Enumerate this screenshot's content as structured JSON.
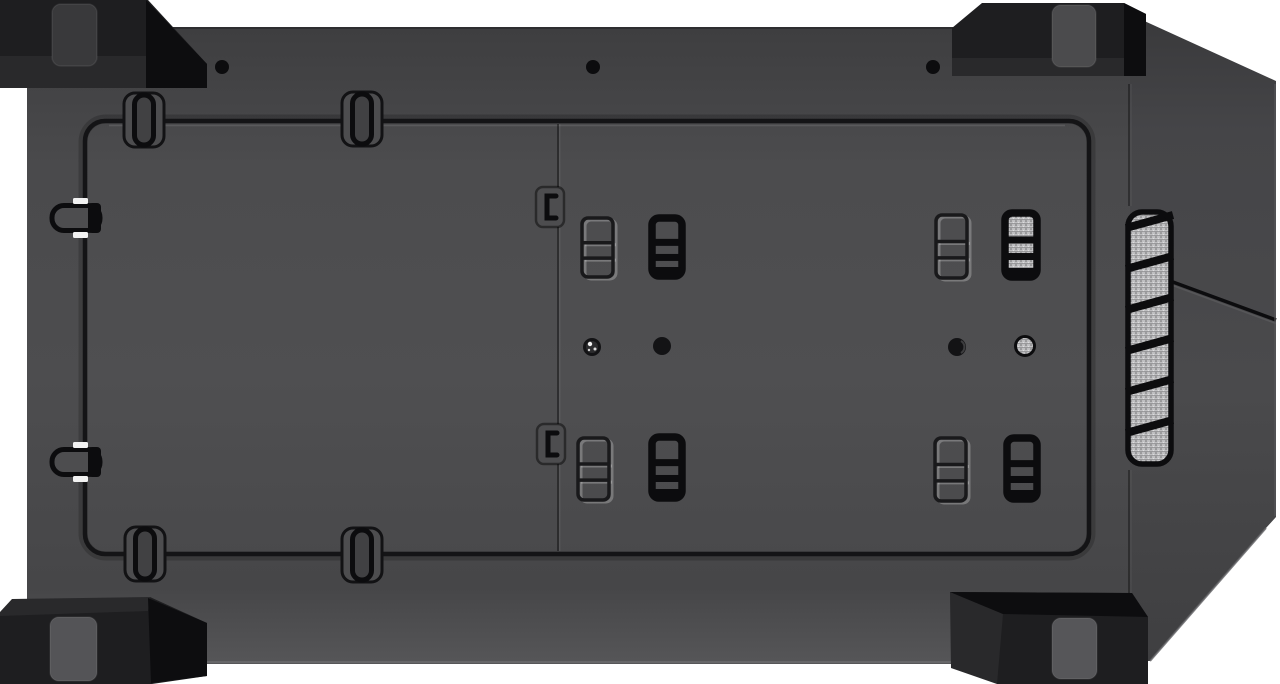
{
  "meta": {
    "subject": "pc-case-bottom-view-product-photo",
    "background_color": "#ffffff"
  },
  "palette": {
    "body_top": "#3e3e40",
    "body_mid": "#4d4d4f",
    "body_low": "#464648",
    "body_rim": "#565658",
    "line_black": "#0c0c0e",
    "groove": "#141416",
    "facet_top": "#39393b",
    "facet_mid": "#4a4a4c",
    "facet_low": "#3f3f41",
    "foot_dark": "#1e1e20",
    "foot_facet": "#0d0d0f",
    "pad_dark": "#39393b",
    "pad_light": "#545457",
    "mesh_base": "#bfbfc1",
    "mesh_dot_dark": "#6e6e70",
    "mesh_dot_light": "#e2e2e4",
    "highlight_white": "#f2f2f2"
  },
  "body_panel": {
    "x": 27,
    "y": 27,
    "w": 1103,
    "h": 637
  },
  "front_facet": {
    "outline": "1129,14 1276,81 1276,517 1266,528 1150,661 1129,661",
    "seam_line": [
      1162,
      278,
      1276,
      320
    ],
    "bottom_edge": [
      1266,
      528,
      1150,
      661
    ]
  },
  "inner_panel": {
    "x": 85,
    "y": 121,
    "w": 1004,
    "h": 433,
    "rx": 20,
    "seam_x": 558,
    "seam_y1": 124,
    "seam_y2": 551
  },
  "vent": {
    "x": 1128,
    "y": 212,
    "w": 43,
    "h": 252,
    "rx": 14,
    "bar_count": 6,
    "bar_step": 41,
    "bar_start_y": 228,
    "bar_rise": 13
  },
  "edge_breaks": [
    {
      "x": 1129,
      "y1": 84,
      "y2": 206
    },
    {
      "x": 1129,
      "y1": 470,
      "y2": 598
    }
  ],
  "pill_slots_vertical": [
    {
      "cx": 144,
      "cy": 120,
      "edge": "top"
    },
    {
      "cx": 362,
      "cy": 119,
      "edge": "top"
    },
    {
      "cx": 145,
      "cy": 554,
      "edge": "bottom"
    },
    {
      "cx": 362,
      "cy": 555,
      "edge": "bottom"
    }
  ],
  "pill_slots_horizontal": [
    {
      "cx": 72,
      "cy": 218
    },
    {
      "cx": 72,
      "cy": 462
    }
  ],
  "latch_holes": [
    {
      "cx": 550,
      "cy": 207
    },
    {
      "cx": 551,
      "cy": 444
    }
  ],
  "clips": [
    {
      "x": 582,
      "y": 218,
      "w": 31,
      "h": 59,
      "style": "embossed"
    },
    {
      "x": 652,
      "y": 218,
      "w": 30,
      "h": 58,
      "style": "solid"
    },
    {
      "x": 936,
      "y": 215,
      "w": 31,
      "h": 63,
      "style": "embossed"
    },
    {
      "x": 1005,
      "y": 213,
      "w": 32,
      "h": 64,
      "style": "solid-mesh"
    },
    {
      "x": 578,
      "y": 438,
      "w": 31,
      "h": 62,
      "style": "embossed"
    },
    {
      "x": 652,
      "y": 437,
      "w": 30,
      "h": 61,
      "style": "solid"
    },
    {
      "x": 935,
      "y": 438,
      "w": 31,
      "h": 63,
      "style": "embossed"
    },
    {
      "x": 1007,
      "y": 438,
      "w": 30,
      "h": 61,
      "style": "solid"
    }
  ],
  "holes_edge": [
    {
      "cx": 222,
      "cy": 67,
      "r": 7
    },
    {
      "cx": 593,
      "cy": 67,
      "r": 7
    },
    {
      "cx": 933,
      "cy": 67,
      "r": 7
    }
  ],
  "holes_center": [
    {
      "cx": 592,
      "cy": 347,
      "r": 9,
      "type": "screw-shiny"
    },
    {
      "cx": 662,
      "cy": 346,
      "r": 9,
      "type": "plain"
    },
    {
      "cx": 957,
      "cy": 347,
      "r": 9,
      "type": "plain-glint"
    },
    {
      "cx": 1025,
      "cy": 346,
      "r": 9.5,
      "type": "mesh"
    }
  ],
  "feet": [
    {
      "name": "foot-top-left",
      "main": "0,0 148,0 207,64 207,88 0,88",
      "facet": "146,0 207,64 207,88 146,88",
      "shade": "0,56 146,56 146,88 0,88",
      "pad": {
        "x": 52,
        "y": 4,
        "w": 45,
        "h": 62,
        "r": 9,
        "fill": "#39393b"
      }
    },
    {
      "name": "foot-top-right",
      "main": "952,28 982,3 1124,3 1146,14 1146,76 952,76",
      "facet": "1124,3 1146,14 1146,76 1124,76",
      "shade": "952,58 1146,58 1146,76 952,76",
      "pad": {
        "x": 1052,
        "y": 5,
        "w": 44,
        "h": 62,
        "r": 9,
        "fill": "#4b4b4d"
      }
    },
    {
      "name": "foot-bottom-left",
      "main": "0,612 12,599 150,597 207,623 207,676 152,684 0,684",
      "facet": "148,598 207,623 207,676 151,683",
      "shade": "0,612 12,599 150,597 148,611 0,616",
      "pad": {
        "x": 50,
        "y": 617,
        "w": 47,
        "h": 64,
        "r": 9,
        "fill": "#545457"
      }
    },
    {
      "name": "foot-bottom-right",
      "main": "950,592 1132,593 1148,617 1148,684 997,684 951,668",
      "facet": "950,592 1132,593 1148,617 1003,614",
      "shade": "950,592 1003,614 997,684 951,668",
      "pad": {
        "x": 1052,
        "y": 618,
        "w": 45,
        "h": 61,
        "r": 9,
        "fill": "#565659"
      }
    }
  ]
}
